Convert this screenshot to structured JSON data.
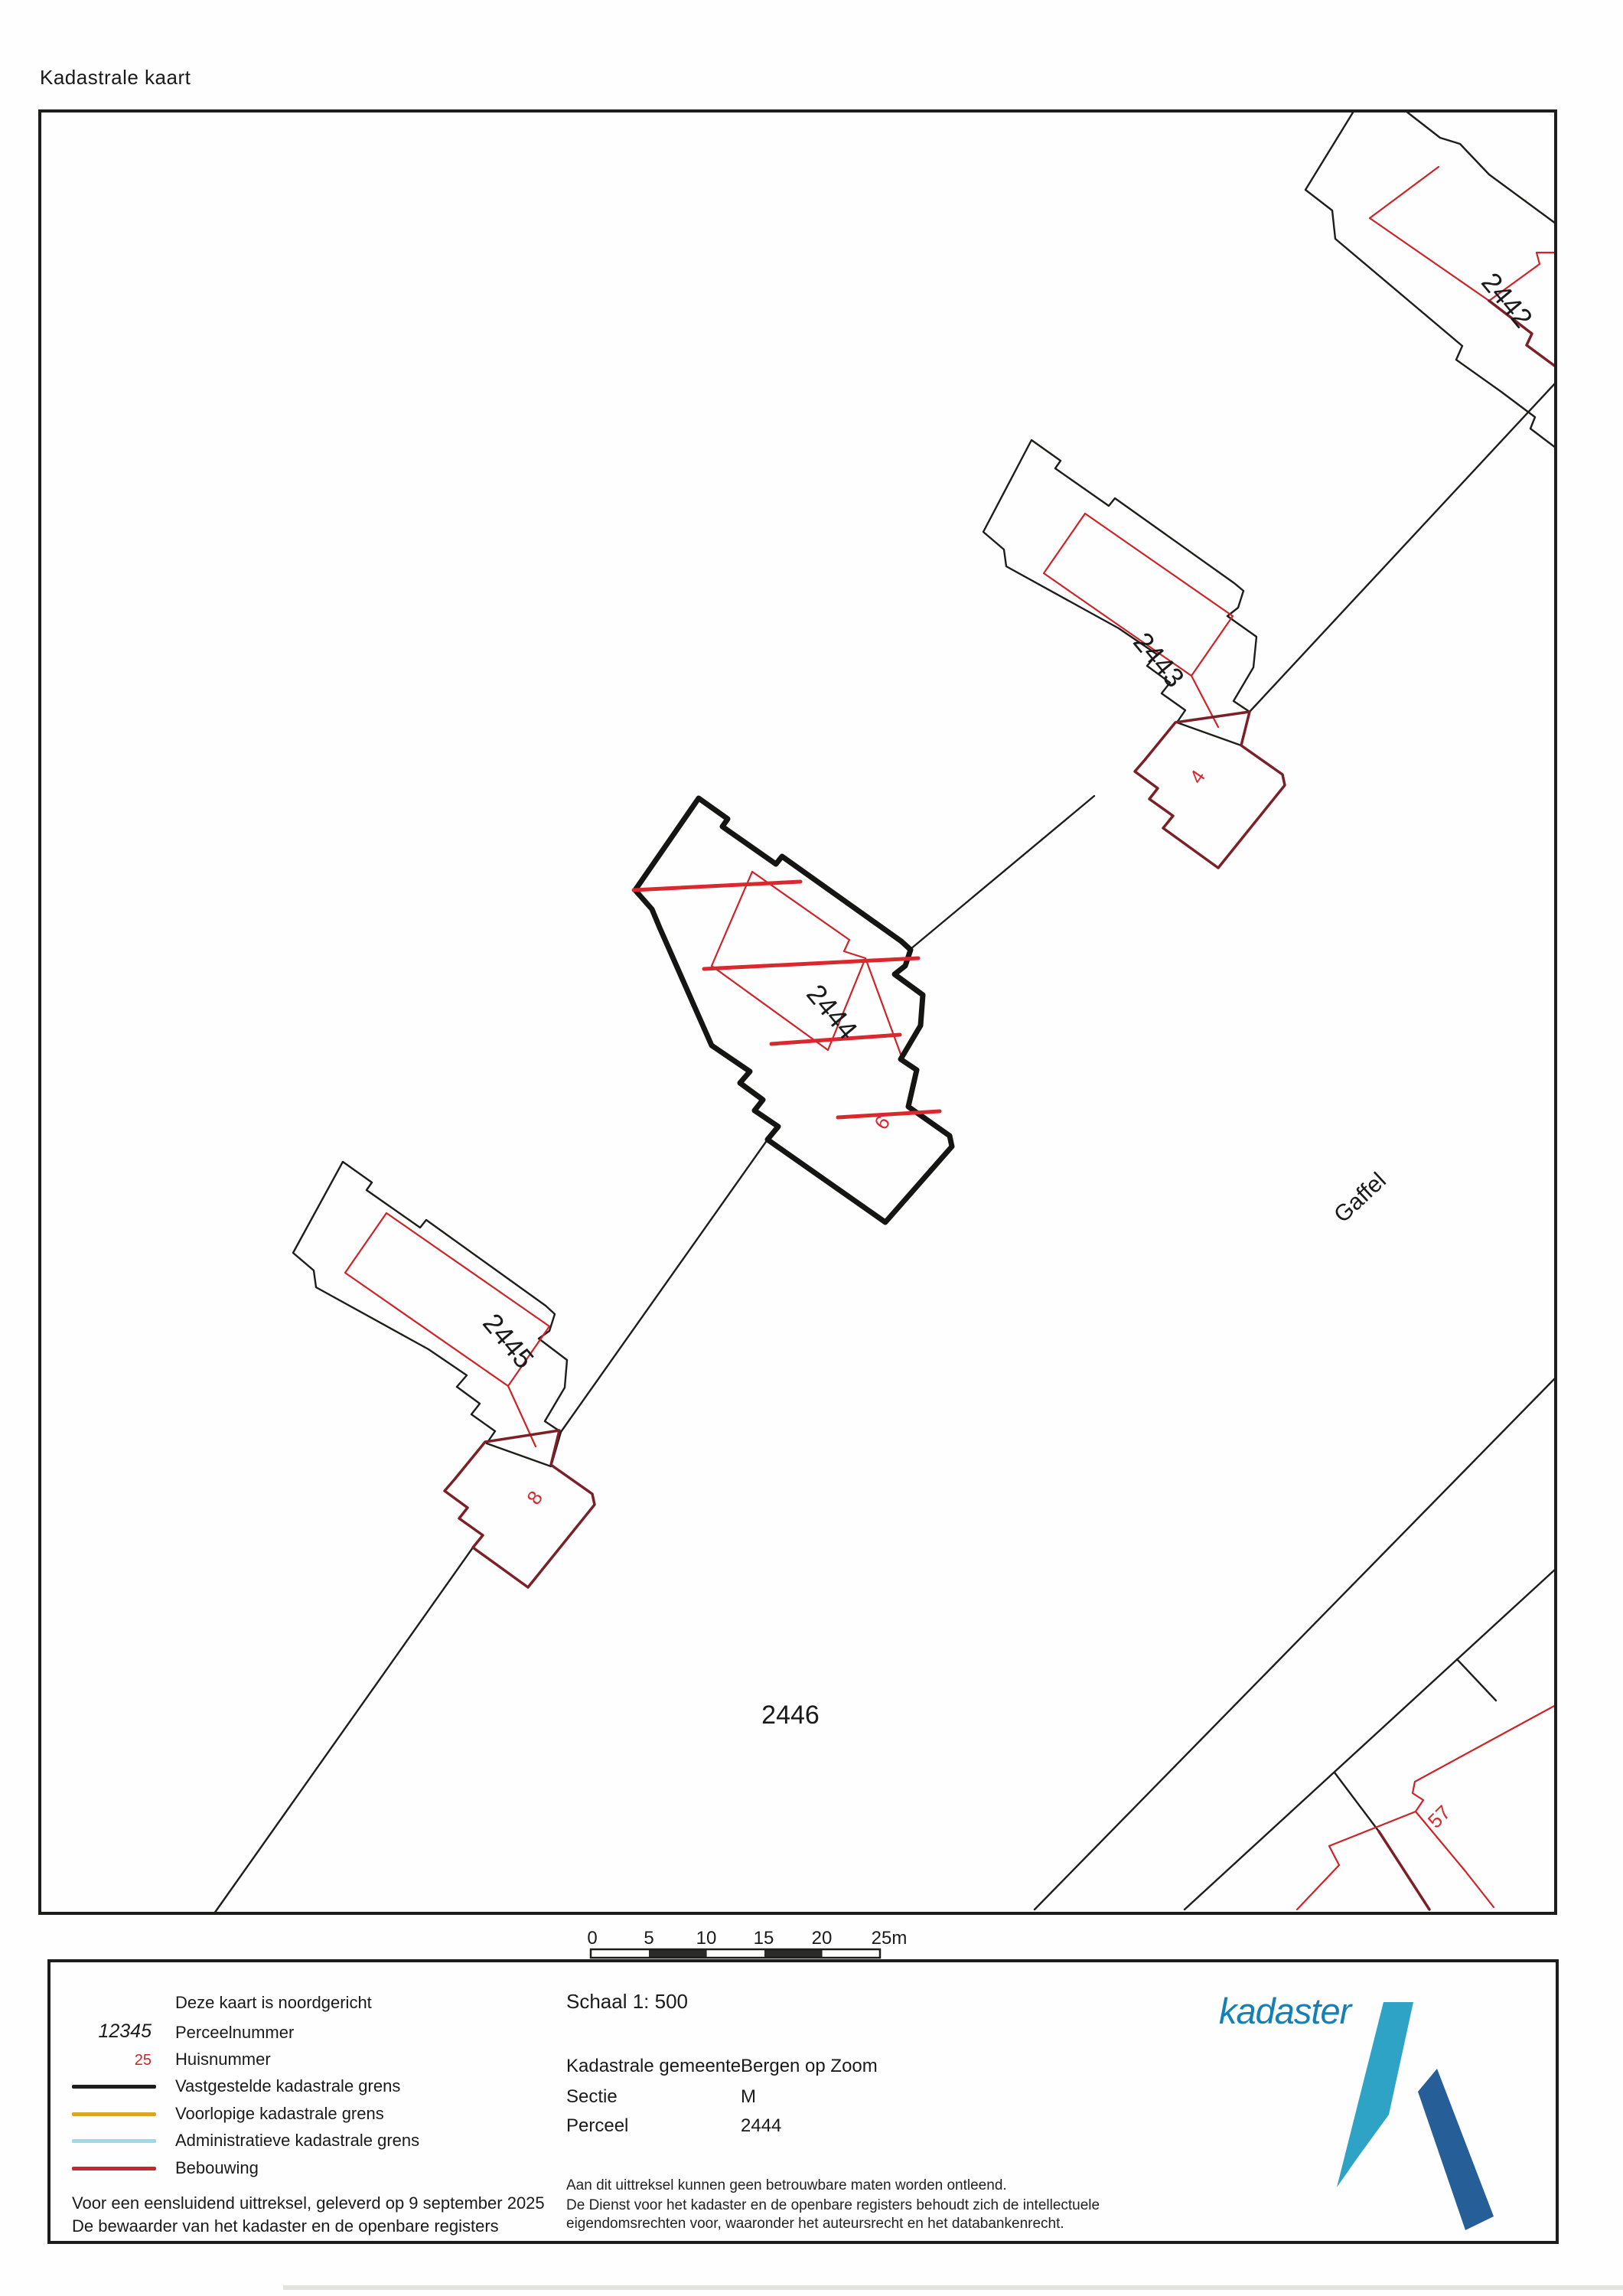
{
  "title": "Kadastrale kaart",
  "map": {
    "parcel_numbers": {
      "p2442": "2442",
      "p2443": "2443",
      "p2444": "2444",
      "p2445": "2445",
      "p2446": "2446"
    },
    "house_numbers": {
      "h4": "4",
      "h6": "6",
      "h8": "8",
      "h57": "57"
    },
    "street_name": "Gaffel",
    "selected_parcel": "2444"
  },
  "scale_bar": {
    "ticks": [
      "0",
      "5",
      "10",
      "15",
      "20"
    ],
    "last_tick": "25m"
  },
  "legend": {
    "north_note": "Deze kaart is noordgericht",
    "parcel_sample": "12345",
    "parcel_label": "Perceelnummer",
    "house_sample": "25",
    "house_label": "Huisnummer",
    "items": [
      {
        "label": "Vastgestelde kadastrale grens",
        "color": "#1d1d1b"
      },
      {
        "label": "Voorlopige kadastrale grens",
        "color": "#d9a526"
      },
      {
        "label": "Administratieve kadastrale grens",
        "color": "#9fd8e6"
      },
      {
        "label": "Bebouwing",
        "color": "#c9252c"
      }
    ],
    "footer_line1": "Voor een eensluidend uittreksel, geleverd op 9 september 2025",
    "footer_line2": "De bewaarder van het kadaster en de openbare registers"
  },
  "info": {
    "scale_label": "Schaal 1: 500",
    "rows": [
      {
        "label": "Kadastrale gemeente",
        "value": "Bergen op Zoom"
      },
      {
        "label": "Sectie",
        "value": "M"
      },
      {
        "label": "Perceel",
        "value": "2444"
      }
    ],
    "disclaimer": [
      "Aan dit uittreksel kunnen geen betrouwbare maten worden ontleend.",
      "De Dienst voor het kadaster en de openbare registers behoudt zich de intellectuele",
      "eigendomsrechten voor, waaronder het auteursrecht en het databankenrecht."
    ]
  },
  "logo": {
    "text": "kadaster"
  },
  "colors": {
    "boundary_black": "#1d1d1b",
    "building_red": "#cc2428",
    "building_dark_red": "#7a2026",
    "wall_bright_red": "#d9282e",
    "provisional_amber": "#d9a526",
    "administrative_blue": "#9fd8e6",
    "logo_text_blue": "#1580b8",
    "logo_light_blue": "#2ea3c6",
    "logo_dark_blue": "#265e97"
  }
}
